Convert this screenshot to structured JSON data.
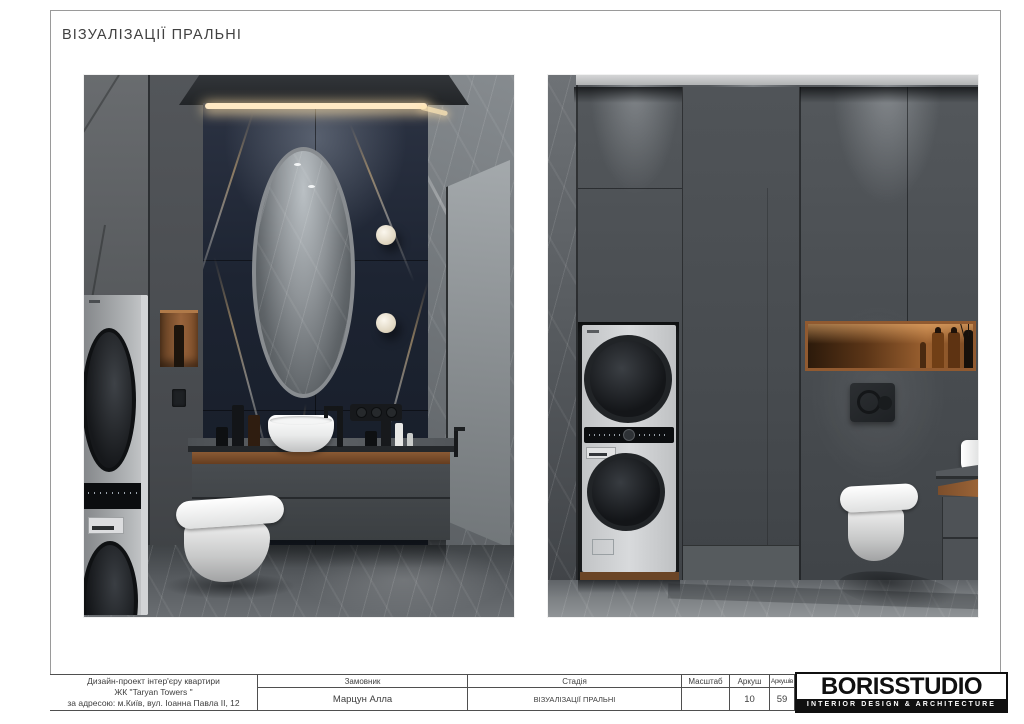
{
  "page": {
    "title": "ВІЗУАЛІЗАЦІЇ ПРАЛЬНІ"
  },
  "title_block": {
    "project": {
      "line1": "Дизайн-проект інтер'єру квартири",
      "line2": "ЖК \"Taryan Towers \"",
      "line3": "за адресою: м.Київ, вул. Іоанна Павла II, 12"
    },
    "customer": {
      "label": "Замовник",
      "value": "Марцун Алла"
    },
    "stage": {
      "label": "Стадія",
      "value": "ВІЗУАЛІЗАЦІЇ ПРАЛЬНІ"
    },
    "scale": {
      "label": "Масштаб",
      "value": ""
    },
    "sheet": {
      "label": "Аркуш",
      "value": "10"
    },
    "sheets_total": {
      "label": "Аркушів",
      "value": "59"
    }
  },
  "logo": {
    "name": "BORISSTUDIO",
    "tagline": "INTERIOR DESIGN & ARCHITECTURE"
  },
  "palette": {
    "paper": "#ffffff",
    "frame_line": "#9a9a9a",
    "table_line": "#4f4f4f",
    "text": "#3e3e3e",
    "logo_ink": "#101010",
    "cabinet_grey": "#4b4f53",
    "marble_navy": "#202734",
    "stone_grey": "#6e7377",
    "wood_accent": "#8a5a33",
    "led_warm": "#f6e3bd"
  }
}
